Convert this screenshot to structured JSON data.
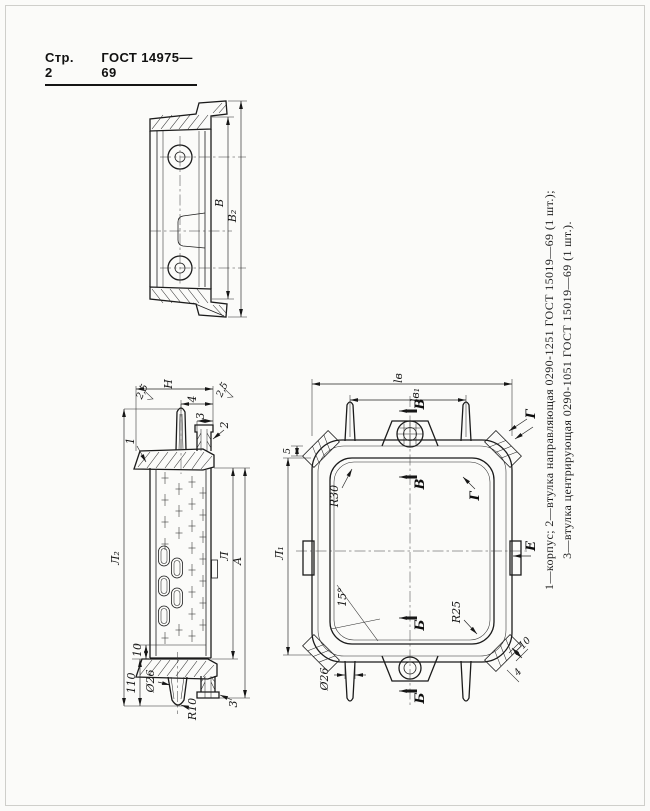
{
  "header": {
    "page_label": "Стр. 2",
    "doc_number": "ГОСТ 14975—69"
  },
  "caption": {
    "line1": "1—корпус; 2—втулка направляющая 0290-1251 ГОСТ 15019—69 (1 шт.);",
    "line2": "3—втулка центрирующая 0290-1051 ГОСТ 15019—69 (1 шт.)."
  },
  "colors": {
    "ink": "#1b1b1b",
    "paper": "#fbfbf9"
  },
  "section_view": {
    "dim_b": "В",
    "dim_b2": "В₂"
  },
  "side_view": {
    "dim_h": "Н",
    "dim_4": "4",
    "dim_3": "3",
    "dim_l2": "Л₂",
    "dim_l": "Л",
    "dim_a": "А",
    "dim_110": "110",
    "dim_10": "10",
    "dim_dia26": "Ø26",
    "dim_r10": "R10",
    "rough_left": "2,5",
    "rough_right": "2,5",
    "item_1": "1",
    "item_2": "2",
    "item_3": "3",
    "cross_marks": [
      [
        165,
        478
      ],
      [
        165,
        500
      ],
      [
        165,
        522
      ],
      [
        165,
        544
      ],
      [
        165,
        638
      ],
      [
        179,
        489
      ],
      [
        179,
        511
      ],
      [
        179,
        533
      ],
      [
        179,
        630
      ],
      [
        192,
        482
      ],
      [
        192,
        504
      ],
      [
        192,
        526
      ],
      [
        192,
        548
      ],
      [
        192,
        570
      ],
      [
        192,
        592
      ],
      [
        192,
        614
      ],
      [
        192,
        636
      ],
      [
        203,
        493
      ],
      [
        203,
        515
      ],
      [
        203,
        537
      ],
      [
        203,
        559
      ],
      [
        203,
        581
      ],
      [
        203,
        603
      ],
      [
        203,
        625
      ]
    ],
    "slots": [
      [
        164,
        556
      ],
      [
        177,
        568
      ],
      [
        164,
        586
      ],
      [
        177,
        598
      ],
      [
        164,
        616
      ]
    ]
  },
  "plan_view": {
    "dim_lv": "lв",
    "dim_lv1": "lв₁",
    "dim_l1": "Л₁",
    "dim_5": "5",
    "dim_r30": "R30",
    "dim_r25": "R25",
    "dim_angle": "15°",
    "dim_dia26": "Ø26",
    "dim_10": "10",
    "dim_4": "4",
    "sec_v": "В",
    "sec_b": "Б",
    "view_g": "Г",
    "view_e": "Е"
  }
}
